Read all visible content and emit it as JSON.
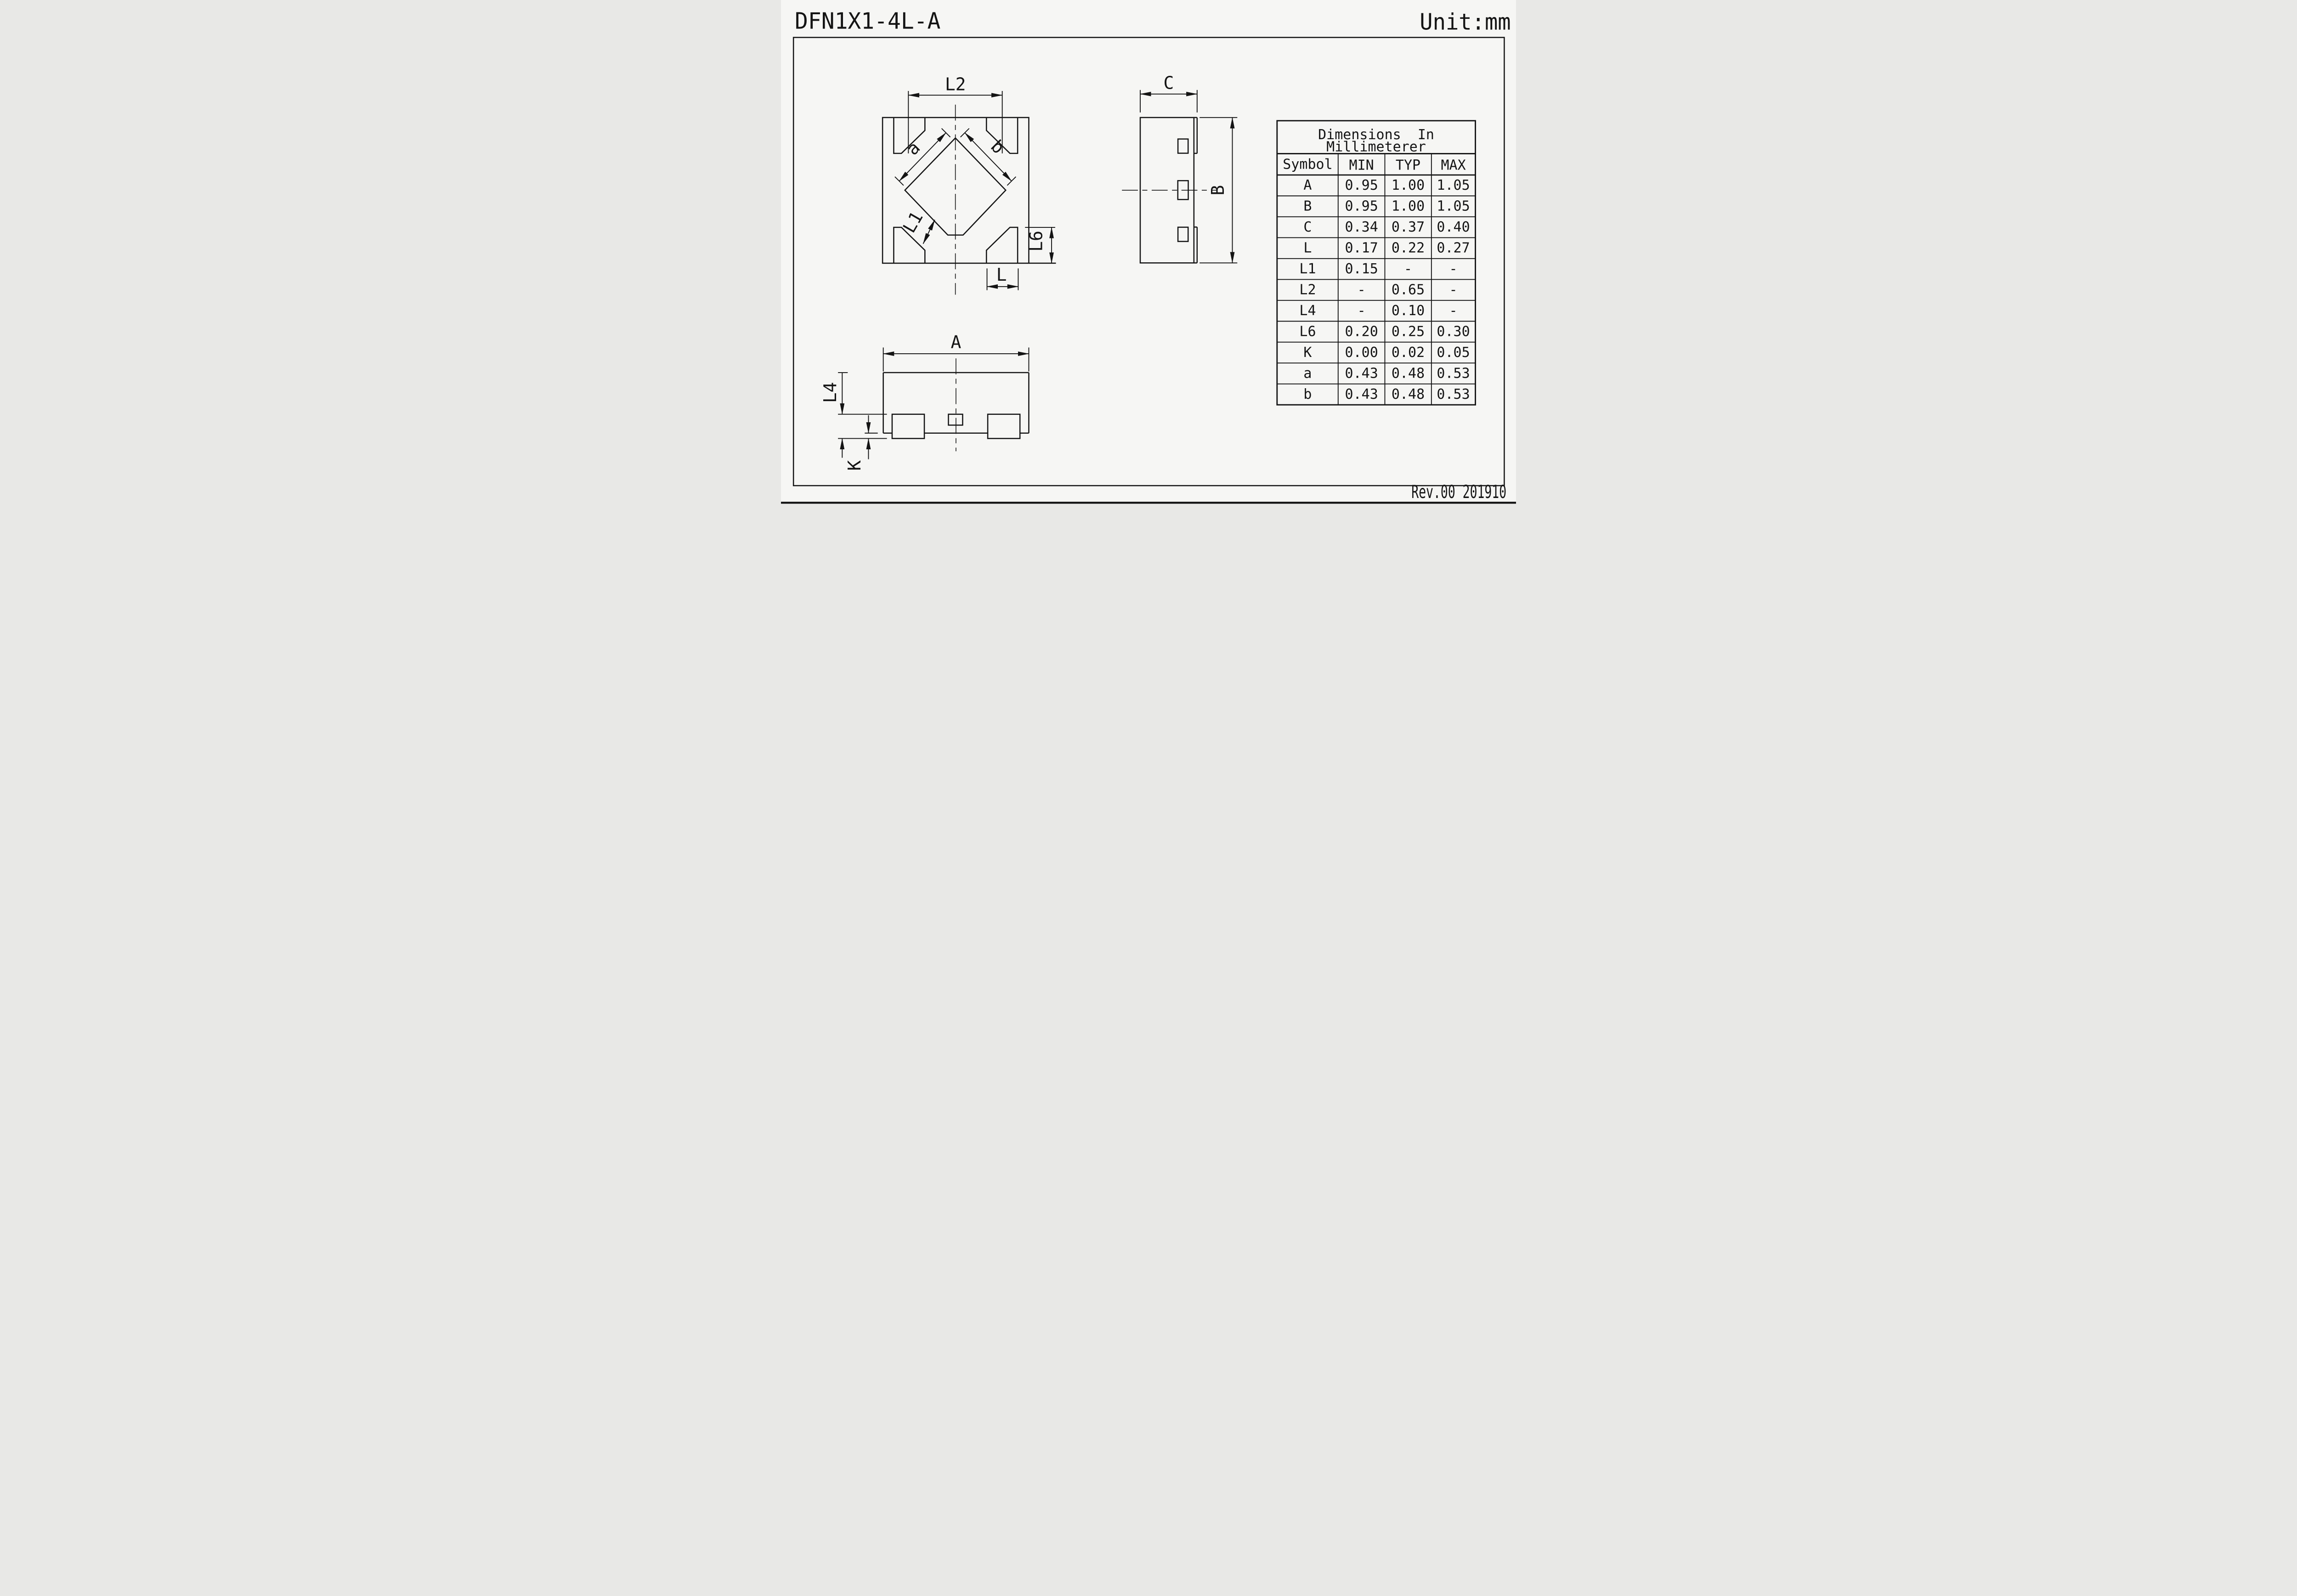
{
  "title": "DFN1X1-4L-A",
  "unit_label": "Unit:mm",
  "revision": "Rev.00 201910",
  "labels": {
    "l2": "L2",
    "a": "a",
    "b": "b",
    "l1": "L1",
    "l6": "L6",
    "l": "L",
    "c": "C",
    "b_side": "B",
    "a_front": "A",
    "l4": "L4",
    "k": "K"
  },
  "table": {
    "title_line1": "Dimensions  In",
    "title_line2": "Millimeterer",
    "columns": [
      "Symbol",
      "MIN",
      "TYP",
      "MAX"
    ],
    "rows": [
      {
        "symbol": "A",
        "min": "0.95",
        "typ": "1.00",
        "max": "1.05"
      },
      {
        "symbol": "B",
        "min": "0.95",
        "typ": "1.00",
        "max": "1.05"
      },
      {
        "symbol": "C",
        "min": "0.34",
        "typ": "0.37",
        "max": "0.40"
      },
      {
        "symbol": "L",
        "min": "0.17",
        "typ": "0.22",
        "max": "0.27"
      },
      {
        "symbol": "L1",
        "min": "0.15",
        "typ": "-",
        "max": "-"
      },
      {
        "symbol": "L2",
        "min": "-",
        "typ": "0.65",
        "max": "-"
      },
      {
        "symbol": "L4",
        "min": "-",
        "typ": "0.10",
        "max": "-"
      },
      {
        "symbol": "L6",
        "min": "0.20",
        "typ": "0.25",
        "max": "0.30"
      },
      {
        "symbol": "K",
        "min": "0.00",
        "typ": "0.02",
        "max": "0.05"
      },
      {
        "symbol": "a",
        "min": "0.43",
        "typ": "0.48",
        "max": "0.53"
      },
      {
        "symbol": "b",
        "min": "0.43",
        "typ": "0.48",
        "max": "0.53"
      }
    ]
  },
  "colors": {
    "ink": "#141414",
    "paper": "#f6f6f4"
  }
}
